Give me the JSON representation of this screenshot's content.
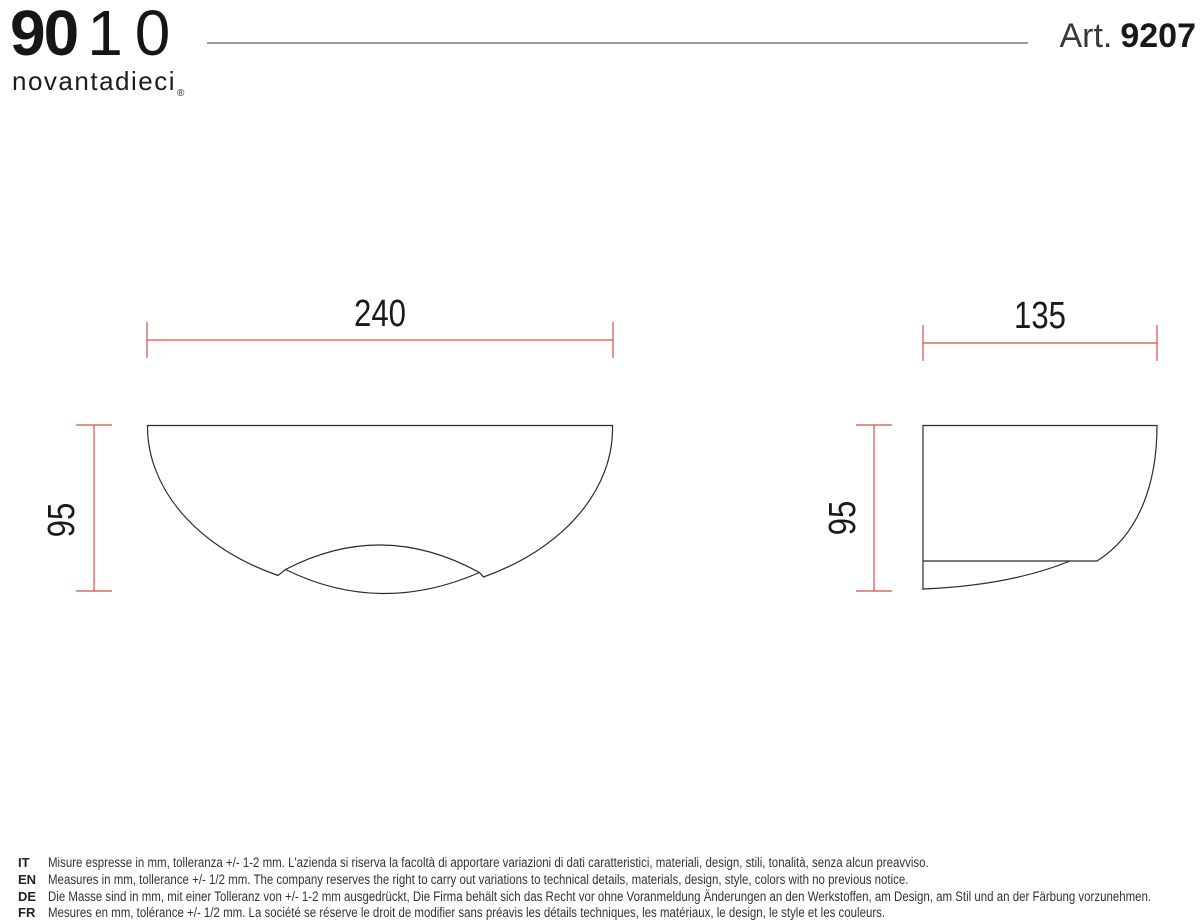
{
  "brand": {
    "numerals_bold": "90",
    "numerals_light": "10",
    "wordmark": "novantadieci",
    "registered": "®"
  },
  "header": {
    "article_label": "Art.",
    "article_number": "9207"
  },
  "views": {
    "front": {
      "width_mm": "240",
      "height_mm": "95"
    },
    "side": {
      "width_mm": "135",
      "height_mm": "95"
    }
  },
  "notes": [
    {
      "lang": "IT",
      "text": "Misure espresse in mm, tolleranza +/- 1-2 mm. L'azienda si riserva la facoltà di apportare variazioni di dati caratteristici, materiali, design, stili, tonalità, senza alcun preavviso."
    },
    {
      "lang": "EN",
      "text": "Measures in mm, tollerance +/- 1/2 mm. The company reserves the right to carry out variations to technical details, materials, design, style, colors with no previous notice."
    },
    {
      "lang": "DE",
      "text": "Die Masse sind in mm, mit einer Tolleranz von +/- 1-2 mm ausgedrückt, Die Firma behält sich das Recht vor ohne Voranmeldung Änderungen an den Werkstoffen, am Design, am Stil und an der Färbung vorzunehmen."
    },
    {
      "lang": "FR",
      "text": "Mesures en mm, tolérance +/- 1/2 mm. La société se réserve le droit de modifier sans préavis les détails techniques, les matériaux, le design, le style et les couleurs."
    }
  ],
  "colors": {
    "dimension": "#cf5045",
    "ink": "#2b2b2b",
    "divider": "#9c9c9c"
  }
}
